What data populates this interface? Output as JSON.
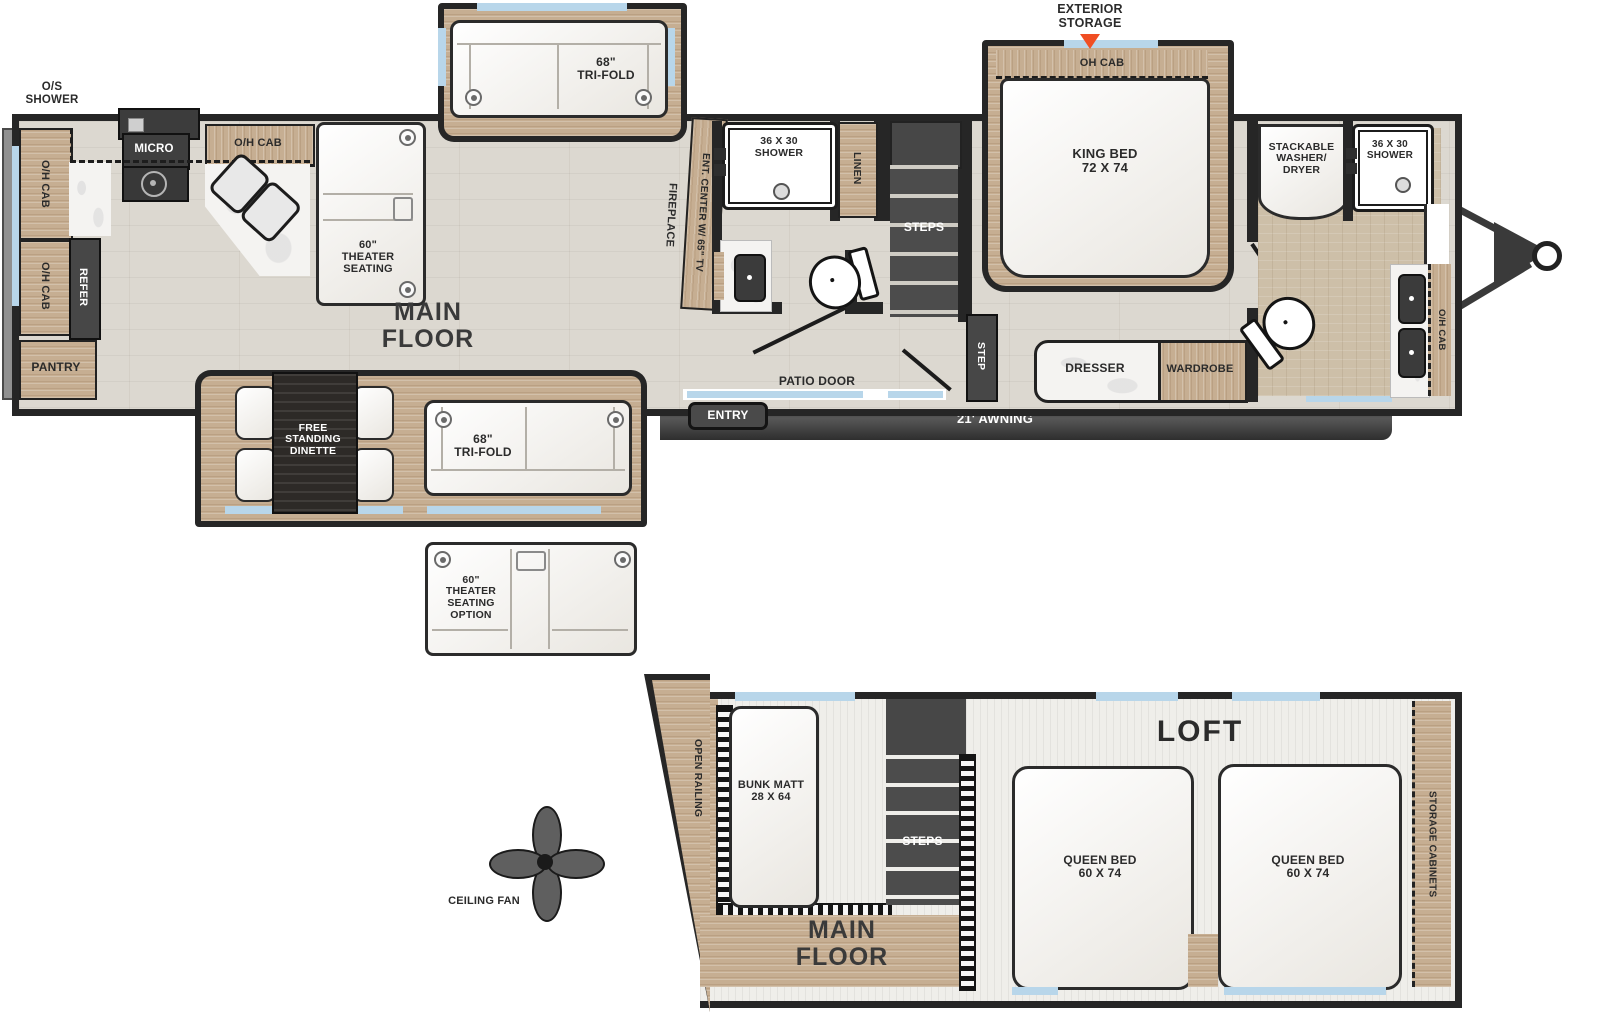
{
  "colors": {
    "wall": "#262626",
    "wood": "#C6AE92",
    "floor": "#DCD8D0",
    "window_blue": "#B8D6EA",
    "accent_orange": "#F04E23",
    "marble": "#F4F3F1"
  },
  "mf": {
    "os_shower": "O/S\nSHOWER",
    "oh_cab": "O/H CAB",
    "micro": "MICRO",
    "refer": "REFER",
    "pantry": "PANTRY",
    "theater": "60\"\nTHEATER\nSEATING",
    "trifold_top": "68\"\nTRI-FOLD",
    "main_floor": "MAIN FLOOR",
    "fireplace": "FIREPLACE",
    "ent_center": "ENT. CENTER W/ 65\" TV",
    "shower_mid": "36 X 30\nSHOWER",
    "linen": "LINEN",
    "steps": "STEPS",
    "step": "STEP",
    "patio_door": "PATIO DOOR",
    "entry": "ENTRY",
    "awning": "21' AWNING",
    "exterior_storage": "EXTERIOR\nSTORAGE",
    "oh_cab_bed": "OH CAB",
    "king_bed": "KING BED\n72 X 74",
    "washer": "STACKABLE\nWASHER/\nDRYER",
    "shower_front": "36 X 30\nSHOWER",
    "dresser": "DRESSER",
    "wardrobe": "WARDROBE",
    "dinette": "FREE\nSTANDING\nDINETTE",
    "trifold_bottom": "68\"\nTRI-FOLD"
  },
  "options": {
    "theater_option": "60\"\nTHEATER\nSEATING\nOPTION",
    "ceiling_fan": "CEILING FAN"
  },
  "loft": {
    "title": "LOFT",
    "open_railing": "OPEN RAILING",
    "bunk": "BUNK MATT\n28 X 64",
    "steps": "STEPS",
    "queen1": "QUEEN BED\n60 X 74",
    "queen2": "QUEEN BED\n60 X 74",
    "storage": "STORAGE CABINETS",
    "main_floor": "MAIN FLOOR"
  }
}
